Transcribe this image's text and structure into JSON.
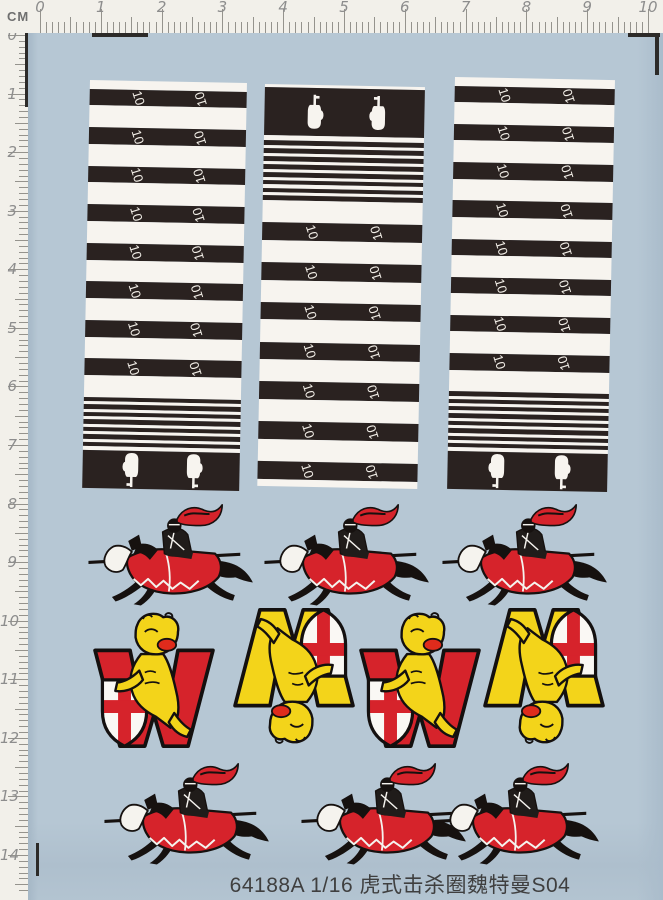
{
  "ruler": {
    "unit_label": "CM",
    "top_numbers": [
      "0",
      "1",
      "2",
      "3",
      "4",
      "5",
      "6",
      "7",
      "8",
      "9",
      "10"
    ],
    "left_numbers": [
      "0",
      "1",
      "2",
      "3",
      "4",
      "5",
      "6",
      "7",
      "8",
      "9",
      "10",
      "11",
      "12",
      "13",
      "14"
    ]
  },
  "sheet": {
    "background_color": "#b6c7d4",
    "ring_label": "10",
    "colors": {
      "strip_black": "#2a2220",
      "strip_white": "#f7f4ef",
      "emblem_red": "#d6232b",
      "emblem_yellow": "#f3d41a",
      "shield_white": "#faf8f4",
      "outline_black": "#16110f"
    },
    "strips": [
      {
        "name": "left",
        "x": 90,
        "y": 80,
        "w": 157,
        "h": 408,
        "segments": [
          {
            "type": "gap",
            "w": 10
          },
          {
            "type": "rings",
            "count": 8,
            "band": 19,
            "gap": 25
          },
          {
            "type": "stripes",
            "count": 7,
            "black": 5,
            "white": 3.5
          },
          {
            "type": "gap",
            "w": 4
          },
          {
            "type": "tanks",
            "w": 44,
            "dir": "down"
          }
        ]
      },
      {
        "name": "middle",
        "x": 265,
        "y": 84,
        "w": 160,
        "h": 402,
        "segments": [
          {
            "type": "gap",
            "w": 3
          },
          {
            "type": "tanks",
            "w": 52,
            "dir": "up"
          },
          {
            "type": "gap",
            "w": 6
          },
          {
            "type": "stripes",
            "count": 8,
            "black": 5,
            "white": 3.5
          },
          {
            "type": "rings",
            "count": 7,
            "band": 19,
            "gap": 24,
            "gapFirst": true
          },
          {
            "type": "gap",
            "w": 8
          }
        ]
      },
      {
        "name": "right",
        "x": 455,
        "y": 77,
        "w": 160,
        "h": 412,
        "segments": [
          {
            "type": "gap",
            "w": 10
          },
          {
            "type": "rings",
            "count": 8,
            "band": 19,
            "gap": 25
          },
          {
            "type": "stripes",
            "count": 8,
            "black": 5,
            "white": 3.5
          },
          {
            "type": "gap",
            "w": 4
          },
          {
            "type": "tanks",
            "w": 44,
            "dir": "down"
          }
        ]
      }
    ],
    "knight_rows": [
      {
        "y": 503,
        "x_positions": [
          82,
          258,
          436
        ]
      },
      {
        "y": 762,
        "x_positions": [
          98,
          295,
          428
        ]
      }
    ],
    "emblem_row": {
      "y": 608,
      "x_positions": [
        88,
        228,
        354,
        478
      ],
      "variants": [
        "red-upright",
        "yellow-inverted",
        "red-upright",
        "yellow-inverted"
      ]
    },
    "caption": "64188A  1/16 虎式击杀圈魏特曼S04"
  }
}
